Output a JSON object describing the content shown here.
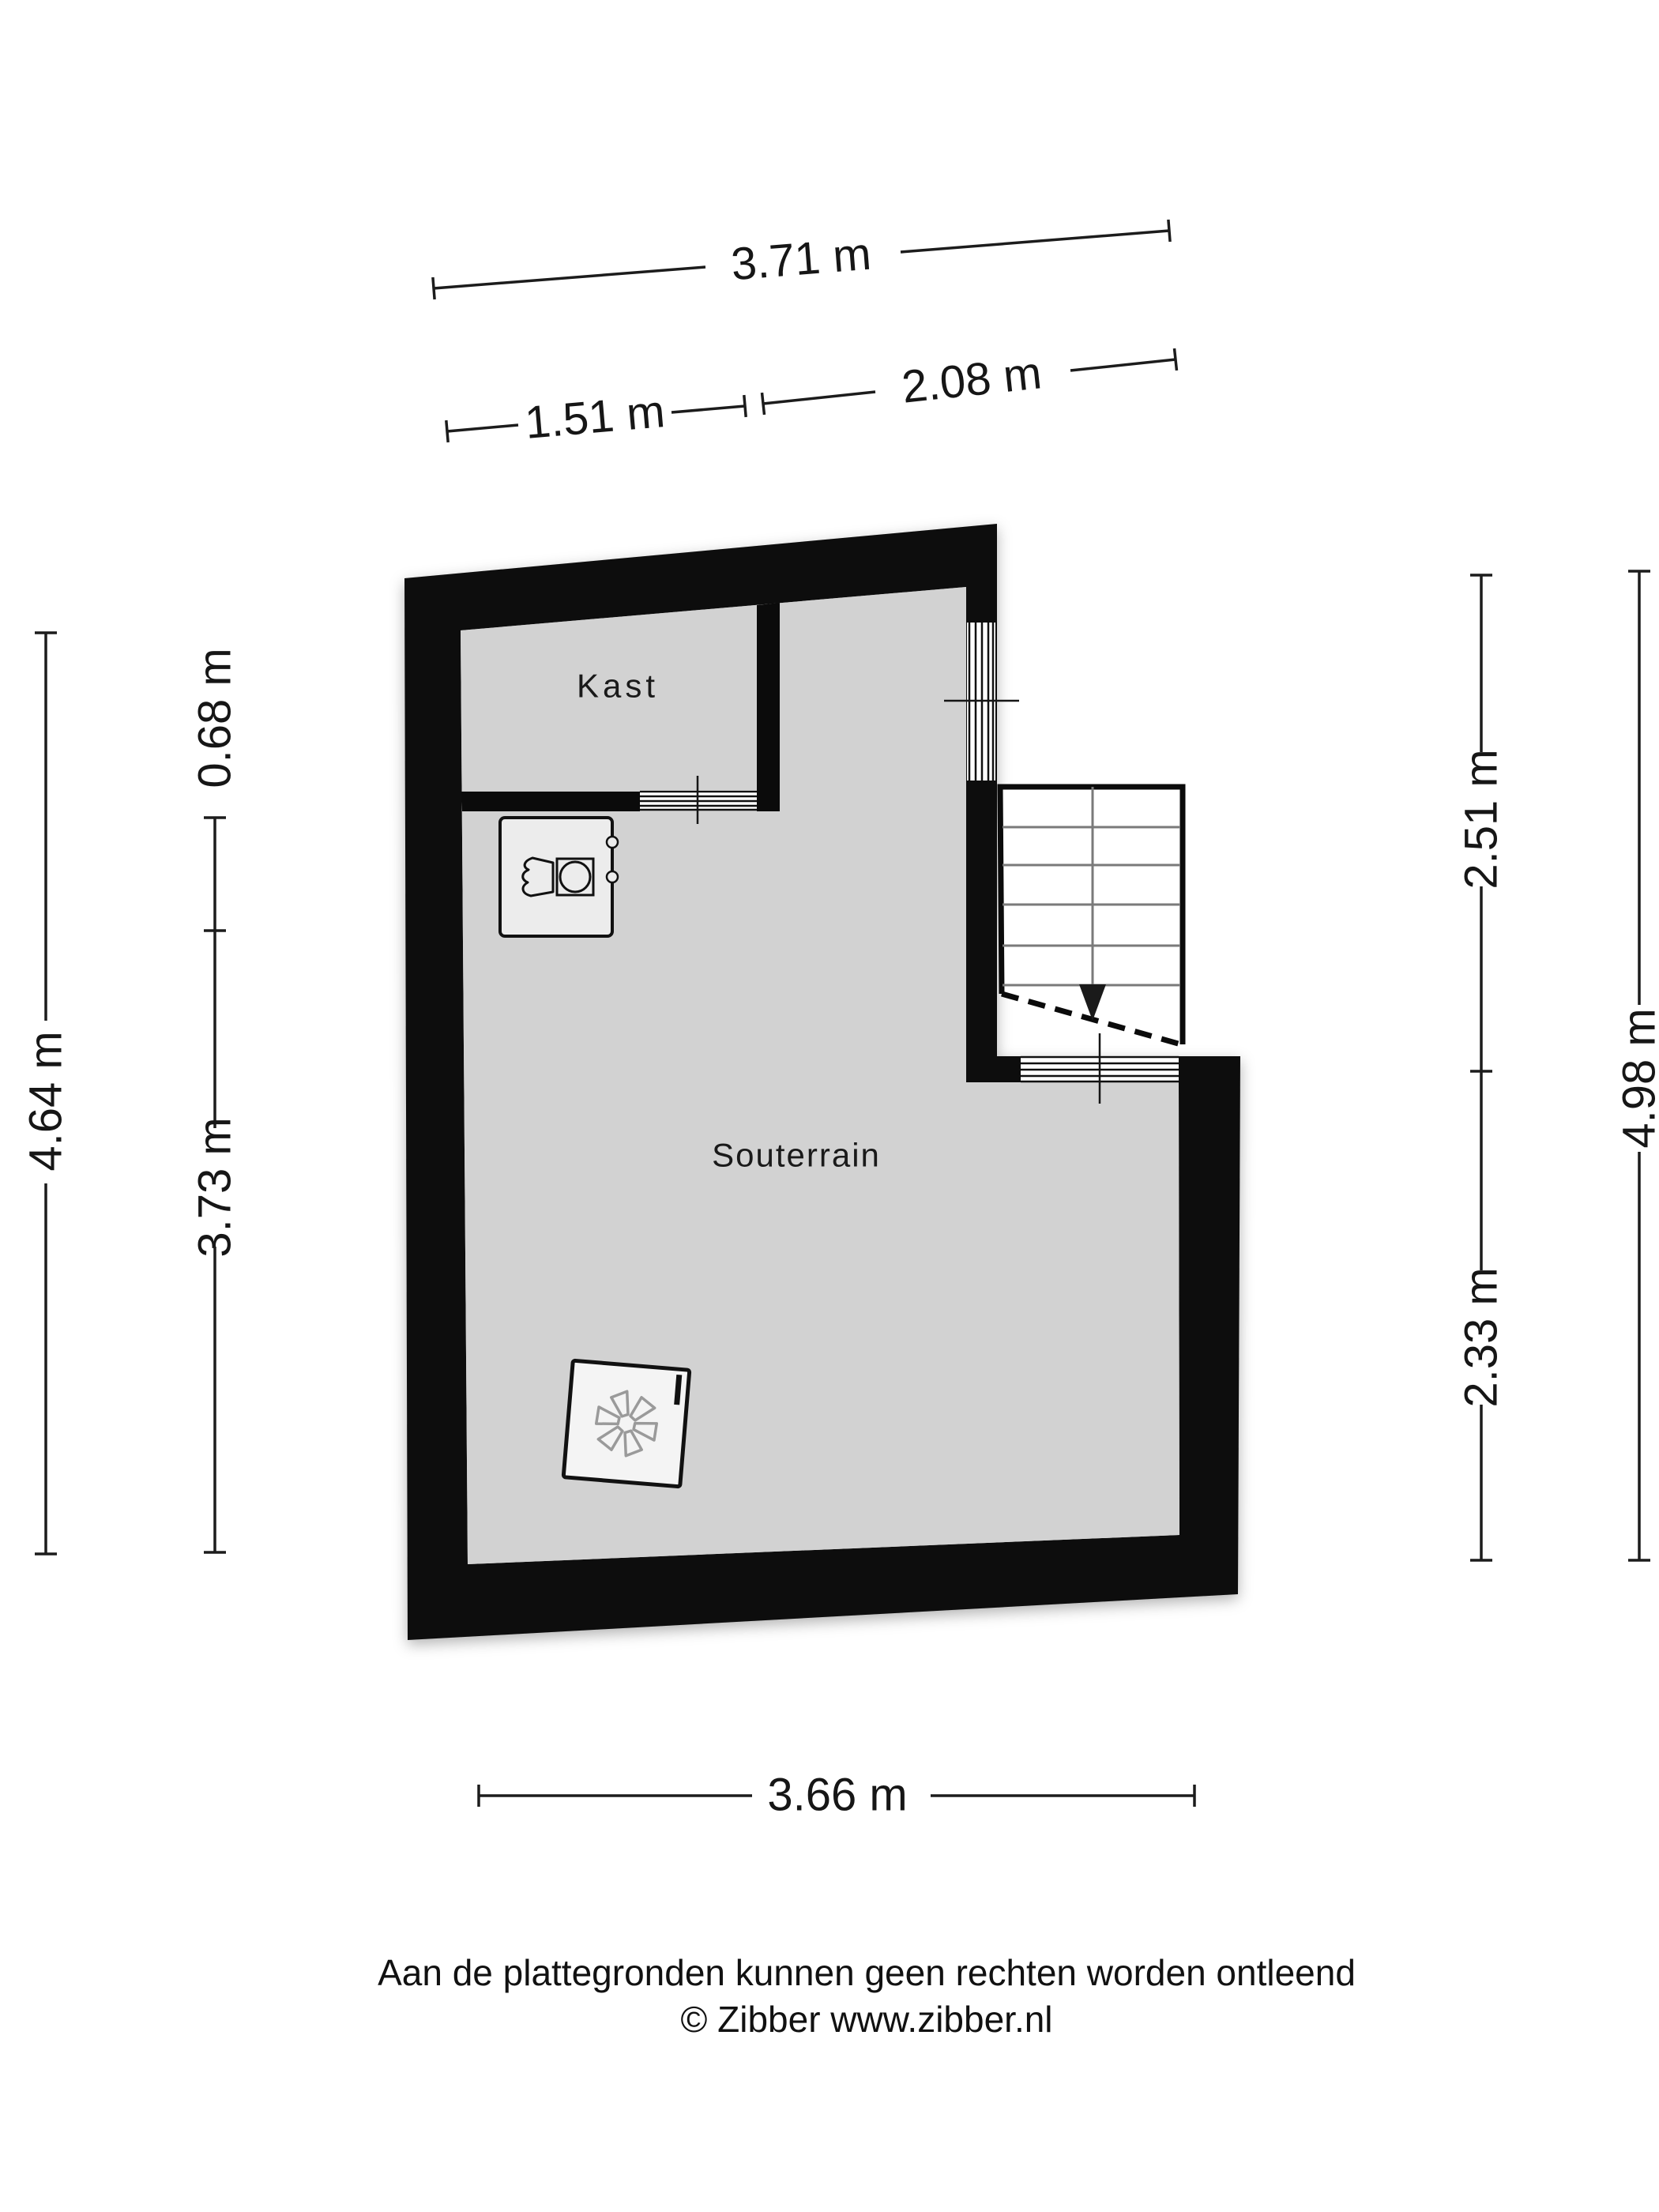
{
  "colors": {
    "walls": "#0b0b0b",
    "floor": "#d2d2d2",
    "appliance_fill": "#ececec",
    "fan_fill": "#f4f4f4",
    "tread_gray": "#7a7a7a",
    "background": "#ffffff"
  },
  "rooms": {
    "kast": {
      "label": "Kast"
    },
    "souterrain": {
      "label": "Souterrain"
    }
  },
  "icons": {
    "washing_machine": "washing-machine-icon",
    "ventilation_unit": "ventilation-fan-icon",
    "stairs_arrow": "stairs-down-arrow-icon"
  },
  "dimensions": {
    "top_total": {
      "label": "3.71 m"
    },
    "top_left": {
      "label": "1.51 m"
    },
    "top_right": {
      "label": "2.08 m"
    },
    "left_outer": {
      "label": "4.64 m"
    },
    "left_upper": {
      "label": "0.68 m"
    },
    "left_lower": {
      "label": "3.73 m"
    },
    "right_upper": {
      "label": "2.51 m"
    },
    "right_lower": {
      "label": "2.33 m"
    },
    "right_outer": {
      "label": "4.98 m"
    },
    "bottom": {
      "label": "3.66 m"
    }
  },
  "footer": {
    "disclaimer": "Aan de plattegronden kunnen geen rechten worden ontleend",
    "credit": "© Zibber www.zibber.nl"
  }
}
